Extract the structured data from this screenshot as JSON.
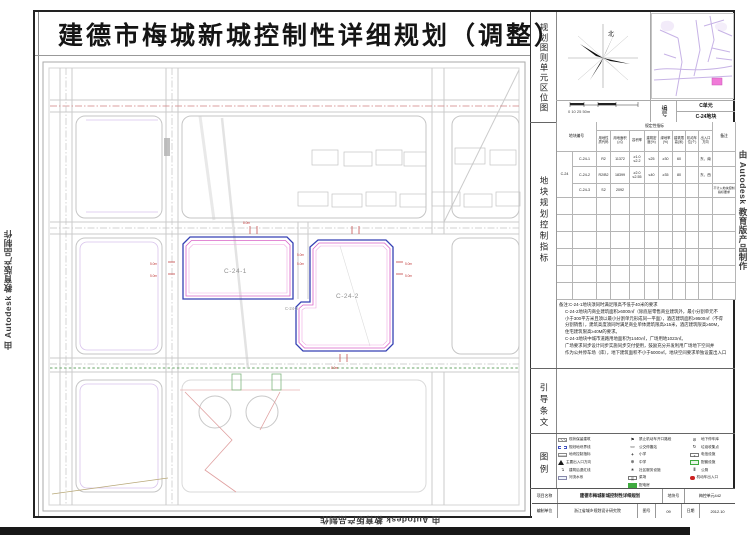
{
  "title": "建德市梅城新城控制性详细规划（调整）",
  "watermark": {
    "text": "由 Autodesk 教育版产品制作"
  },
  "sidebar": {
    "location_section_label": "规划图则单元区位图",
    "north_label": "北",
    "scale_labels": "0  10  25     50m",
    "code_label": "编号",
    "code_unit": "C单元",
    "code_block": "C-24地块",
    "indicators_section_label": "地块规划控制指标",
    "guidance_section_label": "引导条文",
    "legend_section_label": "图例"
  },
  "table": {
    "header_block": "地块编号",
    "header_prescriptive": "规定性指标",
    "header_remarks": "备注",
    "columns": [
      "用地性质代码",
      "用地面积(㎡)",
      "容积率",
      "建筑密度(%)",
      "绿地率(%)",
      "建筑限高(米)",
      "机动车位(个)",
      "出入口方向"
    ],
    "parent_code": "C-24",
    "rows": [
      {
        "code": "C-24-1",
        "nature": "R2",
        "area": "11372",
        "far": "≥1.0 ≤2.2",
        "density": "≤25",
        "green": "≥30",
        "height": "60",
        "parking": "",
        "entry": "东、南",
        "note": ""
      },
      {
        "code": "C-24-2",
        "nature": "R2/B2",
        "area": "18399",
        "far": "≥2.0 ≤2.55",
        "density": "≤40",
        "green": "≥35",
        "height": "80",
        "parking": "",
        "entry": "东、西",
        "note": ""
      },
      {
        "code": "C-24-3",
        "nature": "S2",
        "area": "2092",
        "far": "",
        "density": "",
        "green": "",
        "height": "",
        "parking": "",
        "entry": "",
        "note": "不计入地块控制指标要求"
      }
    ]
  },
  "notes": {
    "line1": "备注:C-24-1地块须同时满足限高不低于40米的要求",
    "line2": "C-24-2地块内商业建筑面积≥6000㎡（除底层零售商业建筑外，最小分割单元不",
    "line3": "小于300平方米且须以最小分割单元形成同一平面），酒店建筑面积≥9500㎡（不得",
    "line4": "分割销售），建筑高度须同时满足商业单体建筑限高≥15米，酒店建筑限高≥50M，",
    "line5": "住宅建筑限高≥40M的要求。",
    "line6": "C-24-3地块中城市道路用地面积为1440㎡，广场用地1023㎡。",
    "line7": "广场要求同步设计同步实施同步交付使用，鼓励充分开发利用广场地下空间并",
    "line8": "作为公共停车场（库），地下建筑面积不小于5000㎡，地块空间要求单独设置出入口"
  },
  "legend": {
    "col1": [
      {
        "icon": "hatch-rect-icon",
        "label": "现状保留建筑"
      },
      {
        "icon": "dashed-boundary-icon",
        "label": "规划地块界线"
      },
      {
        "icon": "indicator-box-icon",
        "label": "地块控制指标"
      },
      {
        "icon": "triangle-icon",
        "label": "主要出入口方向"
      },
      {
        "icon": "setback-arrow-icon",
        "label": "建筑后退红线"
      },
      {
        "icon": "water-rect-icon",
        "label": "河流水系"
      }
    ],
    "col2": [
      {
        "icon": "no-entry-flag-icon",
        "label": "禁止机动车开口路段"
      },
      {
        "icon": "bus-stop-icon",
        "label": "公交停靠站"
      },
      {
        "icon": "plus-icon",
        "label": "小学"
      },
      {
        "icon": "circle-plus-icon",
        "label": "中学"
      },
      {
        "icon": "community-icon",
        "label": "社区服务设施"
      },
      {
        "icon": "market-icon",
        "label": "菜场"
      },
      {
        "icon": "power-room-icon",
        "label": "配电房"
      }
    ],
    "col3": [
      {
        "icon": "underground-parking-icon",
        "label": "地下停车库"
      },
      {
        "icon": "refuse-icon",
        "label": "垃圾收集点"
      },
      {
        "icon": "telecom-icon",
        "label": "电信设施"
      },
      {
        "icon": "green-facility-icon",
        "label": "配套设施"
      },
      {
        "icon": "toilet-icon",
        "label": "公厕"
      },
      {
        "icon": "vehicle-entry-icon",
        "label": "机动车出入口"
      }
    ]
  },
  "titleblock": {
    "project_label": "项目名称",
    "project_value": "建德市梅城新城控制性详细规划",
    "sheet_label": "地块号",
    "sheet_value": "梅控单元442",
    "org_label": "编制单位",
    "org_value": "浙江省城乡规划设计研究院",
    "fig_label": "图号",
    "fig_value": "09",
    "date_label": "日期",
    "date_value": "2012.10"
  },
  "map": {
    "parcel1_label": "C-24-1",
    "parcel2_label": "C-24-2",
    "parcel3_label": "C-24-3",
    "dims": [
      "5.0m",
      "5.0m",
      "5.0m",
      "5.0m",
      "5.0m",
      "5.0m",
      "8.0m",
      "8.0m"
    ]
  },
  "colors": {
    "parcel_blue": "#3642b4",
    "parcel_pink": "#d964c8",
    "road_gray": "#cbcbcb",
    "green_line": "#6aa66a",
    "red_note": "#c03a3a",
    "location_lavender": "#c7b3e6",
    "highlight_pink": "#f07ad8"
  }
}
